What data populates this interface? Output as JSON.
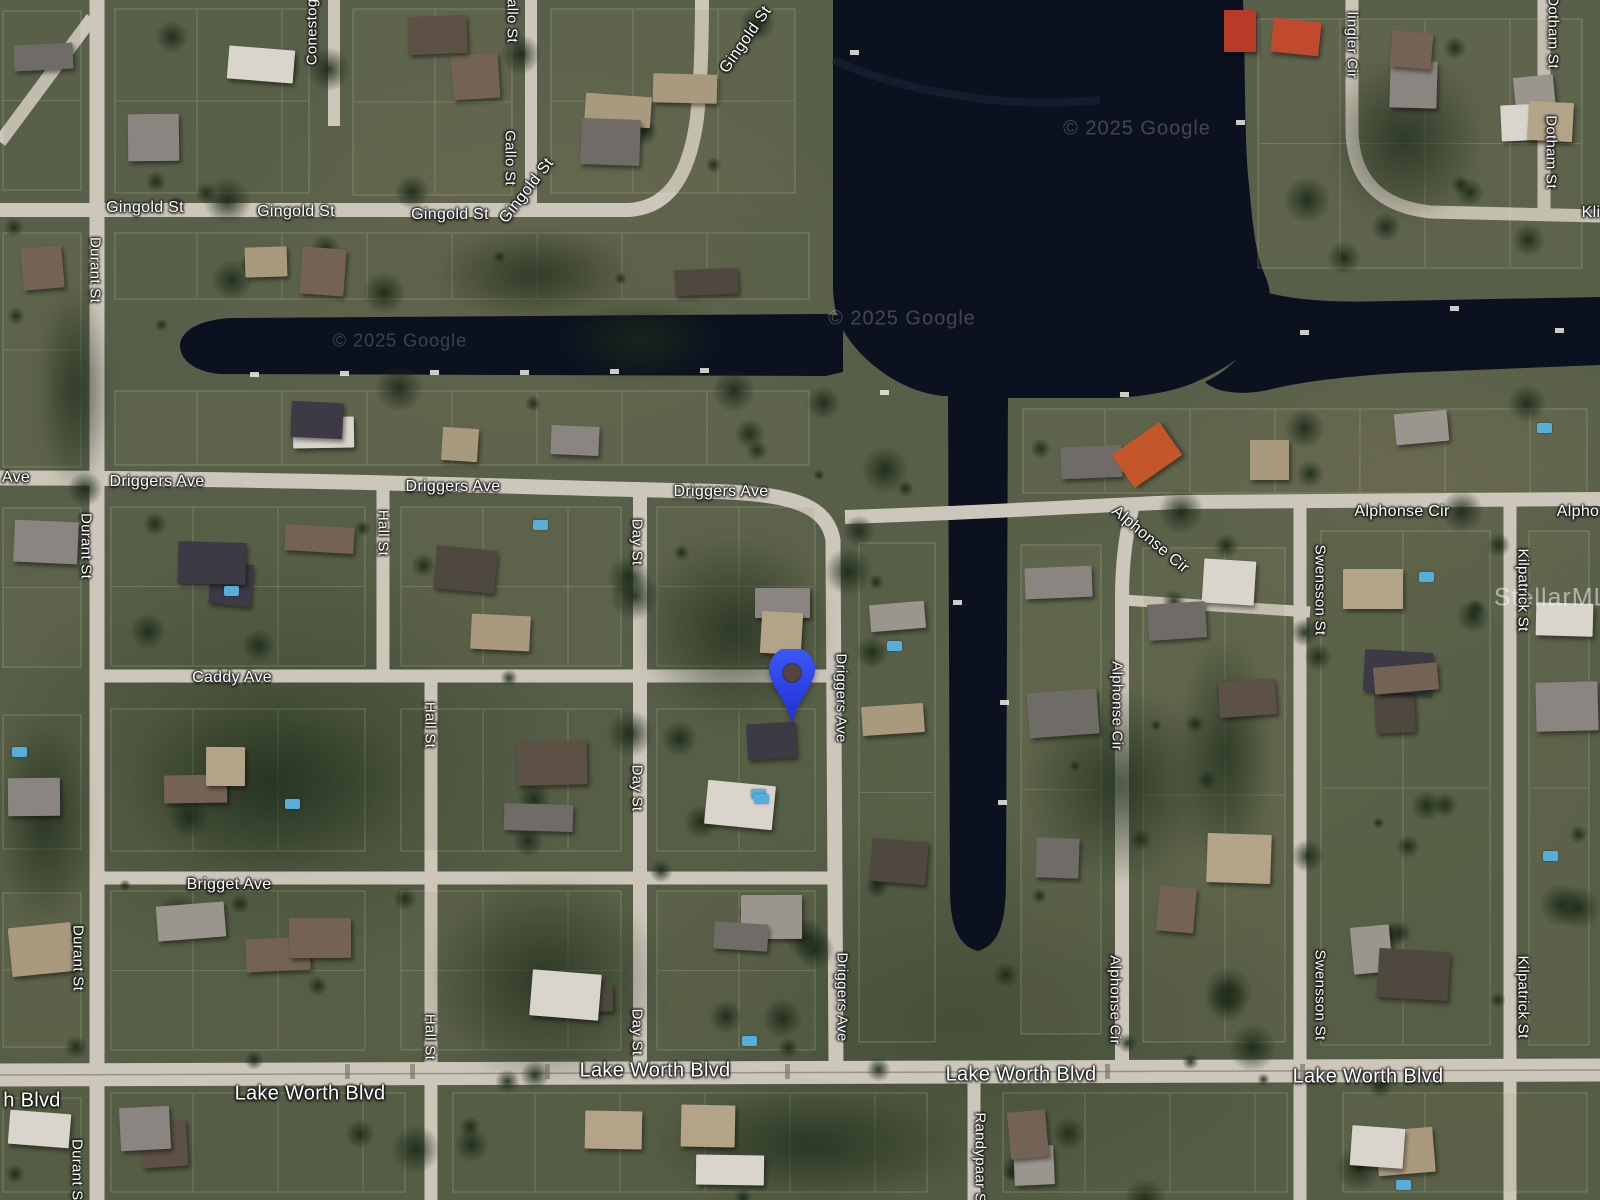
{
  "map": {
    "type": "satellite",
    "street_labels": [
      {
        "text": "Gingold St",
        "x": 145,
        "y": 208,
        "rot": 0,
        "size": 16
      },
      {
        "text": "Gingold St",
        "x": 296,
        "y": 212,
        "rot": 0,
        "size": 16
      },
      {
        "text": "Gingold St",
        "x": 450,
        "y": 215,
        "rot": 0,
        "size": 16
      },
      {
        "text": "Gingold St",
        "x": 527,
        "y": 191,
        "rot": -52,
        "size": 16
      },
      {
        "text": "Gingold St",
        "x": 746,
        "y": 40,
        "rot": -55,
        "size": 16
      },
      {
        "text": "Driggers Ave",
        "x": 157,
        "y": 482,
        "rot": 0,
        "size": 16
      },
      {
        "text": "Driggers Ave",
        "x": 453,
        "y": 487,
        "rot": 0,
        "size": 16
      },
      {
        "text": "Driggers Ave",
        "x": 721,
        "y": 492,
        "rot": 0,
        "size": 16
      },
      {
        "text": "Caddy Ave",
        "x": 232,
        "y": 678,
        "rot": 0,
        "size": 16
      },
      {
        "text": "Brigget Ave",
        "x": 229,
        "y": 885,
        "rot": 0,
        "size": 16
      },
      {
        "text": "Ave",
        "x": 16,
        "y": 478,
        "rot": 0,
        "size": 16
      },
      {
        "text": "h Blvd",
        "x": 32,
        "y": 1101,
        "rot": 0,
        "size": 20
      },
      {
        "text": "Lake Worth Blvd",
        "x": 310,
        "y": 1094,
        "rot": 0,
        "size": 20
      },
      {
        "text": "Lake Worth Blvd",
        "x": 655,
        "y": 1071,
        "rot": 0,
        "size": 20
      },
      {
        "text": "Lake Worth Blvd",
        "x": 1021,
        "y": 1075,
        "rot": 0,
        "size": 20
      },
      {
        "text": "Lake Worth Blvd",
        "x": 1368,
        "y": 1077,
        "rot": 0,
        "size": 20
      },
      {
        "text": "Alphonse Cir",
        "x": 1402,
        "y": 512,
        "rot": 0,
        "size": 16
      },
      {
        "text": "Alpho",
        "x": 1578,
        "y": 512,
        "rot": 0,
        "size": 16
      },
      {
        "text": "Alphonse Cir",
        "x": 1150,
        "y": 540,
        "rot": 40,
        "size": 16
      },
      {
        "text": "Kli",
        "x": 1591,
        "y": 213,
        "rot": 0,
        "size": 16
      },
      {
        "text": "lingler Cir",
        "x": 1352,
        "y": 45,
        "rot": 90,
        "size": 15
      },
      {
        "text": "Durant St",
        "x": 95,
        "y": 270,
        "rot": 90,
        "size": 15
      },
      {
        "text": "Durant St",
        "x": 86,
        "y": 546,
        "rot": 90,
        "size": 15
      },
      {
        "text": "Durant St",
        "x": 78,
        "y": 958,
        "rot": 90,
        "size": 15
      },
      {
        "text": "Durant St",
        "x": 77,
        "y": 1172,
        "rot": 90,
        "size": 15
      },
      {
        "text": "Hall St",
        "x": 383,
        "y": 533,
        "rot": 90,
        "size": 15
      },
      {
        "text": "Hall St",
        "x": 430,
        "y": 725,
        "rot": 90,
        "size": 15
      },
      {
        "text": "Hall St",
        "x": 430,
        "y": 1037,
        "rot": 90,
        "size": 15
      },
      {
        "text": "Day St",
        "x": 637,
        "y": 542,
        "rot": 90,
        "size": 15
      },
      {
        "text": "Day St",
        "x": 637,
        "y": 788,
        "rot": 90,
        "size": 15
      },
      {
        "text": "Day St",
        "x": 637,
        "y": 1032,
        "rot": 90,
        "size": 15
      },
      {
        "text": "Driggers Ave",
        "x": 841,
        "y": 698,
        "rot": 90,
        "size": 15
      },
      {
        "text": "Driggers Ave",
        "x": 842,
        "y": 997,
        "rot": 90,
        "size": 15
      },
      {
        "text": "Gallo St",
        "x": 512,
        "y": 15,
        "rot": 90,
        "size": 15
      },
      {
        "text": "Gallo St",
        "x": 510,
        "y": 158,
        "rot": 90,
        "size": 15
      },
      {
        "text": "Conestoga St",
        "x": 312,
        "y": 18,
        "rot": -90,
        "size": 15
      },
      {
        "text": "Dotham St",
        "x": 1553,
        "y": 32,
        "rot": 90,
        "size": 15
      },
      {
        "text": "Dotham St",
        "x": 1551,
        "y": 152,
        "rot": 90,
        "size": 15
      },
      {
        "text": "Swensson St",
        "x": 1320,
        "y": 590,
        "rot": 90,
        "size": 15
      },
      {
        "text": "Swensson St",
        "x": 1320,
        "y": 995,
        "rot": 90,
        "size": 15
      },
      {
        "text": "Kilpatrick St",
        "x": 1523,
        "y": 590,
        "rot": 90,
        "size": 15
      },
      {
        "text": "Kilpatrick St",
        "x": 1523,
        "y": 997,
        "rot": 90,
        "size": 15
      },
      {
        "text": "Randypaar St",
        "x": 980,
        "y": 1160,
        "rot": 90,
        "size": 15
      },
      {
        "text": "Alphonse Cir",
        "x": 1117,
        "y": 706,
        "rot": 90,
        "size": 15
      },
      {
        "text": "Alphonse Cir",
        "x": 1115,
        "y": 1000,
        "rot": 90,
        "size": 15
      }
    ],
    "watermarks": [
      {
        "text": "© 2025 Google",
        "x": 1137,
        "y": 129,
        "size": 20,
        "opacity": 0.22
      },
      {
        "text": "© 2025 Google",
        "x": 902,
        "y": 319,
        "size": 20,
        "opacity": 0.22
      },
      {
        "text": "© 2025 Google",
        "x": 400,
        "y": 341,
        "size": 18,
        "opacity": 0.2
      },
      {
        "text": "StellarMLS",
        "x": 1560,
        "y": 598,
        "size": 25,
        "opacity": 0.5
      }
    ],
    "pin": {
      "icon": "map-pin-icon",
      "color": "#2e46ee",
      "x": 792,
      "y": 723
    },
    "colors": {
      "water": "#0c1120",
      "road": "#ccc7ba",
      "pin_blue": "#2e46ee",
      "label_text": "#ffffff"
    }
  }
}
